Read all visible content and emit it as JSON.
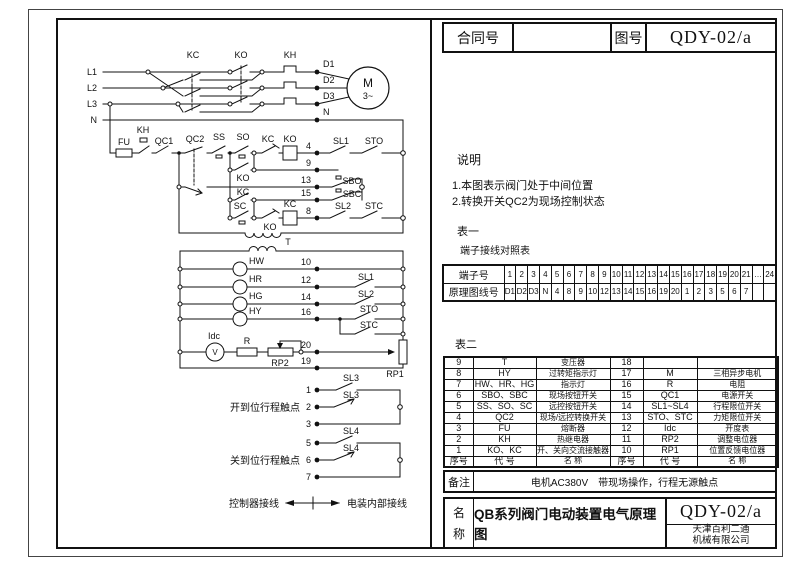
{
  "header": {
    "contract_label": "合同号",
    "contract_value": "",
    "drawing_label": "图号",
    "drawing_no": "QDY-02/a"
  },
  "notes": {
    "title": "说明",
    "items": [
      "1.本图表示阀门处于中间位置",
      "2.转换开关QC2为现场控制状态"
    ]
  },
  "table1": {
    "label": "表一",
    "title": "端子接线对照表",
    "row1_header": "端子号",
    "row2_header": "原理图线号",
    "terminals": [
      "1",
      "2",
      "3",
      "4",
      "5",
      "6",
      "7",
      "8",
      "9",
      "10",
      "11",
      "12",
      "13",
      "14",
      "15",
      "16",
      "17",
      "18",
      "19",
      "20",
      "21",
      "…",
      "24"
    ],
    "wires": [
      "D1",
      "D2",
      "D3",
      "N",
      "4",
      "8",
      "9",
      "10",
      "12",
      "13",
      "14",
      "15",
      "16",
      "19",
      "20",
      "1",
      "2",
      "3",
      "5",
      "6",
      "7",
      "",
      ""
    ]
  },
  "table2": {
    "label": "表二",
    "rows": [
      [
        "9",
        "T",
        "变压器",
        "18",
        "",
        ""
      ],
      [
        "8",
        "HY",
        "过转矩指示灯",
        "17",
        "M",
        "三相异步电机"
      ],
      [
        "7",
        "HW、HR、HG",
        "指示灯",
        "16",
        "R",
        "电阻"
      ],
      [
        "6",
        "SBO、SBC",
        "现场按钮开关",
        "15",
        "QC1",
        "电源开关"
      ],
      [
        "5",
        "SS、SO、SC",
        "远控按钮开关",
        "14",
        "SL1~SL4",
        "行程限位开关"
      ],
      [
        "4",
        "QC2",
        "现场/远控转换开关",
        "13",
        "STO、STC",
        "力矩限位开关"
      ],
      [
        "3",
        "FU",
        "熔断器",
        "12",
        "Idc",
        "开度表"
      ],
      [
        "2",
        "KH",
        "热继电器",
        "11",
        "RP2",
        "调整电位器"
      ],
      [
        "1",
        "KO、KC",
        "开、关向交流接触器",
        "10",
        "RP1",
        "位置反馈电位器"
      ]
    ],
    "footer": [
      "序号",
      "代 号",
      "名 称",
      "序号",
      "代 号",
      "名 称"
    ]
  },
  "remark": {
    "label": "备注",
    "text": "电机AC380V　带现场操作，行程无源触点"
  },
  "titleblock": {
    "label_chars": [
      "名",
      "称"
    ],
    "title": "QB系列阀门电动装置电气原理图",
    "drawing_no": "QDY-02/a",
    "company": [
      "天津百利二通",
      "机械有限公司"
    ]
  },
  "circuit": {
    "line_color": "#111111",
    "labels": [
      {
        "t": "L1",
        "x": 97,
        "y": 75,
        "a": "end"
      },
      {
        "t": "L2",
        "x": 97,
        "y": 91,
        "a": "end"
      },
      {
        "t": "L3",
        "x": 97,
        "y": 107,
        "a": "end"
      },
      {
        "t": "N",
        "x": 97,
        "y": 123,
        "a": "end"
      },
      {
        "t": "KC",
        "x": 193,
        "y": 58
      },
      {
        "t": "KO",
        "x": 241,
        "y": 58
      },
      {
        "t": "KH",
        "x": 290,
        "y": 58
      },
      {
        "t": "D1",
        "x": 323,
        "y": 67,
        "a": "start"
      },
      {
        "t": "D2",
        "x": 323,
        "y": 83,
        "a": "start"
      },
      {
        "t": "D3",
        "x": 323,
        "y": 99,
        "a": "start"
      },
      {
        "t": "N",
        "x": 323,
        "y": 115,
        "a": "start"
      },
      {
        "t": "M",
        "x": 368,
        "y": 87,
        "s": 12
      },
      {
        "t": "3~",
        "x": 368,
        "y": 99
      },
      {
        "t": "FU",
        "x": 124,
        "y": 145
      },
      {
        "t": "KH",
        "x": 143,
        "y": 133
      },
      {
        "t": "QC1",
        "x": 164,
        "y": 144
      },
      {
        "t": "QC2",
        "x": 195,
        "y": 142
      },
      {
        "t": "SS",
        "x": 219,
        "y": 140
      },
      {
        "t": "SO",
        "x": 243,
        "y": 140
      },
      {
        "t": "KC",
        "x": 268,
        "y": 142
      },
      {
        "t": "KO",
        "x": 290,
        "y": 142
      },
      {
        "t": "4",
        "x": 311,
        "y": 149,
        "a": "end"
      },
      {
        "t": "SL1",
        "x": 341,
        "y": 144
      },
      {
        "t": "STO",
        "x": 374,
        "y": 144
      },
      {
        "t": "9",
        "x": 311,
        "y": 166,
        "a": "end"
      },
      {
        "t": "KO",
        "x": 243,
        "y": 181
      },
      {
        "t": "13",
        "x": 311,
        "y": 183,
        "a": "end"
      },
      {
        "t": "SBO",
        "x": 352,
        "y": 184
      },
      {
        "t": "KC",
        "x": 243,
        "y": 195
      },
      {
        "t": "15",
        "x": 311,
        "y": 196,
        "a": "end"
      },
      {
        "t": "SBC",
        "x": 352,
        "y": 197
      },
      {
        "t": "SC",
        "x": 240,
        "y": 209
      },
      {
        "t": "KO",
        "x": 270,
        "y": 230
      },
      {
        "t": "KC",
        "x": 290,
        "y": 207
      },
      {
        "t": "8",
        "x": 311,
        "y": 214,
        "a": "end"
      },
      {
        "t": "SL2",
        "x": 343,
        "y": 209
      },
      {
        "t": "STC",
        "x": 374,
        "y": 209
      },
      {
        "t": "T",
        "x": 288,
        "y": 245
      },
      {
        "t": "HW",
        "x": 249,
        "y": 264,
        "a": "start"
      },
      {
        "t": "HR",
        "x": 249,
        "y": 282,
        "a": "start"
      },
      {
        "t": "HG",
        "x": 249,
        "y": 299,
        "a": "start"
      },
      {
        "t": "HY",
        "x": 249,
        "y": 314,
        "a": "start"
      },
      {
        "t": "10",
        "x": 311,
        "y": 265,
        "a": "end"
      },
      {
        "t": "12",
        "x": 311,
        "y": 283,
        "a": "end"
      },
      {
        "t": "14",
        "x": 311,
        "y": 300,
        "a": "end"
      },
      {
        "t": "16",
        "x": 311,
        "y": 315,
        "a": "end"
      },
      {
        "t": "SL1",
        "x": 366,
        "y": 280
      },
      {
        "t": "SL2",
        "x": 366,
        "y": 297
      },
      {
        "t": "STO",
        "x": 369,
        "y": 312
      },
      {
        "t": "STC",
        "x": 369,
        "y": 328
      },
      {
        "t": "Idc",
        "x": 214,
        "y": 339
      },
      {
        "t": "V",
        "x": 215,
        "y": 355,
        "s": 8
      },
      {
        "t": "R",
        "x": 247,
        "y": 344
      },
      {
        "t": "RP2",
        "x": 280,
        "y": 366
      },
      {
        "t": "20",
        "x": 311,
        "y": 348,
        "a": "end"
      },
      {
        "t": "RP1",
        "x": 395,
        "y": 377
      },
      {
        "t": "19",
        "x": 311,
        "y": 364,
        "a": "end"
      },
      {
        "t": "1",
        "x": 311,
        "y": 393,
        "a": "end"
      },
      {
        "t": "SL3",
        "x": 351,
        "y": 381
      },
      {
        "t": "2",
        "x": 311,
        "y": 410,
        "a": "end"
      },
      {
        "t": "SL3",
        "x": 351,
        "y": 398
      },
      {
        "t": "3",
        "x": 311,
        "y": 427,
        "a": "end"
      },
      {
        "t": "5",
        "x": 311,
        "y": 446,
        "a": "end"
      },
      {
        "t": "SL4",
        "x": 351,
        "y": 434
      },
      {
        "t": "6",
        "x": 311,
        "y": 463,
        "a": "end"
      },
      {
        "t": "SL4",
        "x": 351,
        "y": 451
      },
      {
        "t": "7",
        "x": 311,
        "y": 480,
        "a": "end"
      },
      {
        "t": "开到位行程触点",
        "x": 300,
        "y": 411,
        "a": "end",
        "s": 10
      },
      {
        "t": "关到位行程触点",
        "x": 300,
        "y": 464,
        "a": "end",
        "s": 10
      },
      {
        "t": "控制器接线",
        "x": 279,
        "y": 507,
        "a": "end",
        "s": 10
      },
      {
        "t": "电装内部接线",
        "x": 347,
        "y": 507,
        "a": "start",
        "s": 10
      }
    ]
  }
}
